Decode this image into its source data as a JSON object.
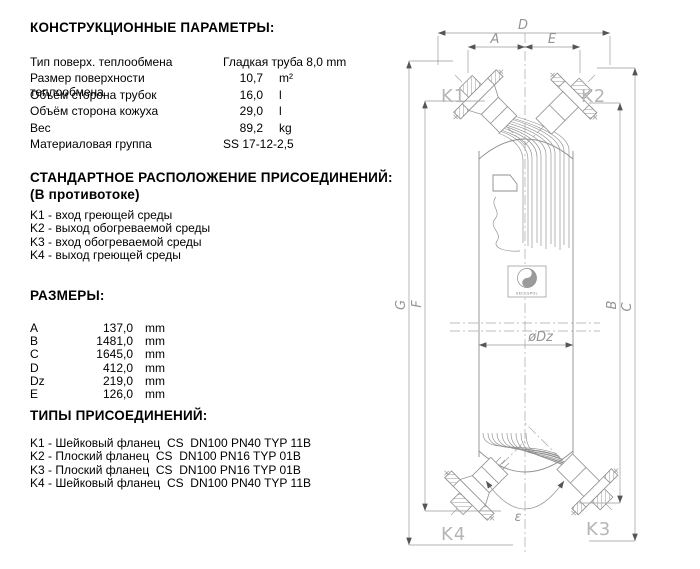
{
  "construction": {
    "title": "КОНСТРУКЦИОННЫЕ ПАРАМЕТРЫ:",
    "rows": [
      {
        "label": "Тип поверх. теплообмена",
        "value": "Гладкая труба 8,0 mm",
        "unit": ""
      },
      {
        "label": "Размер поверхности теплообмена",
        "value": "10,7",
        "unit": "m²"
      },
      {
        "label": "Объём сторона трубок",
        "value": "16,0",
        "unit": "l"
      },
      {
        "label": "Объём сторона кожуха",
        "value": "29,0",
        "unit": "l"
      },
      {
        "label": "Вес",
        "value": "89,2",
        "unit": "kg"
      },
      {
        "label": "Материаловая группа",
        "value": "SS 17-12-2,5",
        "unit": ""
      }
    ]
  },
  "arrangement": {
    "title": "СТАНДАРТНОЕ РАСПОЛОЖЕНИЕ ПРИСОЕДИНЕНИЙ:",
    "subtitle": "(В противотоке)",
    "items": [
      "K1 - вход греющей среды",
      "K2 - выход обогреваемой среды",
      "K3 - вход обогреваемой среды",
      "K4 - выход греющей среды"
    ]
  },
  "dimensions": {
    "title": "РАЗМЕРЫ:",
    "rows": [
      {
        "label": "A",
        "value": "137,0",
        "unit": "mm"
      },
      {
        "label": "B",
        "value": "1481,0",
        "unit": "mm"
      },
      {
        "label": "C",
        "value": "1645,0",
        "unit": "mm"
      },
      {
        "label": "D",
        "value": "412,0",
        "unit": "mm"
      },
      {
        "label": "Dz",
        "value": "219,0",
        "unit": "mm"
      },
      {
        "label": "E",
        "value": "126,0",
        "unit": "mm"
      }
    ]
  },
  "connections": {
    "title": "ТИПЫ ПРИСОЕДИНЕНИЙ:",
    "items": [
      "K1 - Шейковый фланец  CS  DN100 PN40 TYP 11B",
      "K2 - Плоский фланец  CS  DN100 PN16 TYP 01B",
      "K3 - Плоский фланец  CS  DN100 PN16 TYP 01B",
      "K4 - Шейковый фланец  CS  DN100 PN40 TYP 11B"
    ]
  },
  "drawing": {
    "port_labels": {
      "k1": "K1",
      "k2": "K2",
      "k3": "K3",
      "k4": "K4"
    },
    "dim_labels": {
      "d": "D",
      "a": "A",
      "e": "E",
      "g": "G",
      "f": "F",
      "b": "B",
      "c": "C",
      "dz": "øDz",
      "angle": "ε"
    },
    "logo_text": "SECESPOL",
    "colors": {
      "line": "#8f8f8f",
      "dim": "#9a9a9a",
      "port_label": "#b5b5b5",
      "text": "#000000"
    }
  }
}
